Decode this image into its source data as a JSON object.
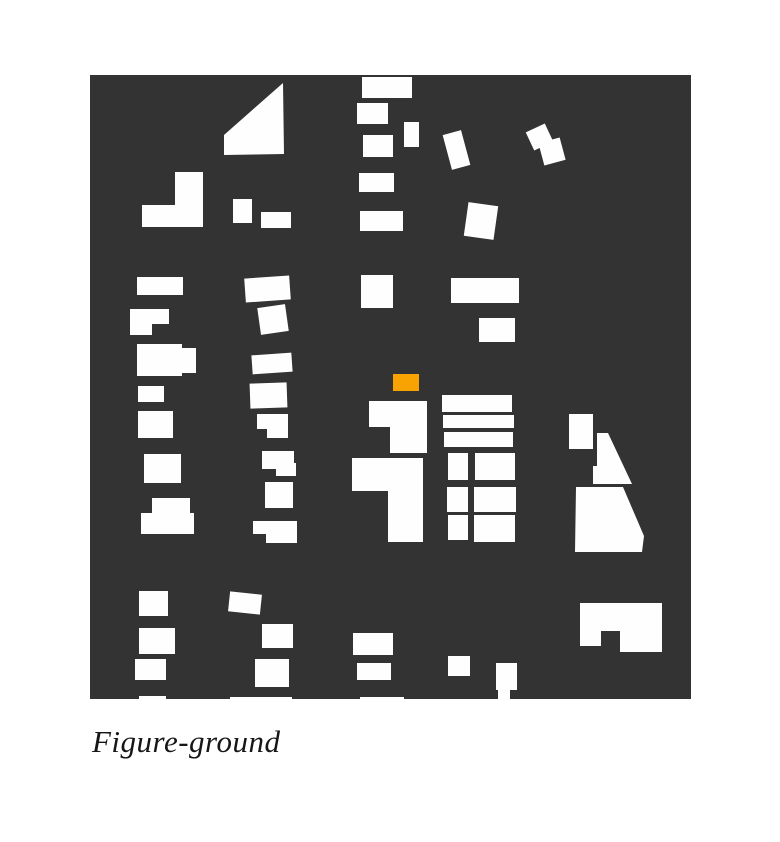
{
  "caption": {
    "text": "Figure-ground"
  },
  "colors": {
    "page_bg": "#ffffff",
    "ground": "#333333",
    "figure": "#fefefe",
    "highlight": "#F8A301"
  },
  "canvas": {
    "x": 90,
    "y": 75,
    "width": 601,
    "height": 624
  },
  "buildings": {
    "rects": [
      [
        272,
        2,
        50,
        21
      ],
      [
        267,
        28,
        31,
        21
      ],
      [
        314,
        47,
        15,
        25
      ],
      [
        273,
        60,
        30,
        22
      ],
      [
        269,
        98,
        35,
        19
      ],
      [
        270,
        136,
        43,
        20
      ],
      [
        271,
        200,
        32,
        33
      ],
      [
        85,
        97,
        28,
        55
      ],
      [
        52,
        130,
        61,
        22
      ],
      [
        143,
        124,
        19,
        24
      ],
      [
        171,
        137,
        30,
        16
      ],
      [
        357,
        57,
        19,
        36,
        -15
      ],
      [
        439,
        52,
        21,
        20,
        -25
      ],
      [
        451,
        65,
        22,
        23,
        -15
      ],
      [
        376,
        129,
        30,
        34,
        8
      ],
      [
        47,
        202,
        46,
        18
      ],
      [
        40,
        234,
        39,
        15
      ],
      [
        40,
        234,
        22,
        26
      ],
      [
        155,
        202,
        45,
        24,
        -4
      ],
      [
        169,
        231,
        28,
        27,
        -8
      ],
      [
        361,
        203,
        68,
        25
      ],
      [
        389,
        243,
        36,
        24
      ],
      [
        47,
        269,
        45,
        32
      ],
      [
        92,
        273,
        14,
        25
      ],
      [
        48,
        311,
        26,
        16
      ],
      [
        48,
        336,
        35,
        27
      ],
      [
        54,
        379,
        37,
        29
      ],
      [
        62,
        423,
        38,
        16
      ],
      [
        51,
        438,
        53,
        21
      ],
      [
        49,
        516,
        29,
        25
      ],
      [
        49,
        553,
        36,
        26
      ],
      [
        45,
        584,
        31,
        21
      ],
      [
        162,
        279,
        40,
        19,
        -4
      ],
      [
        160,
        308,
        37,
        25,
        -2
      ],
      [
        167,
        339,
        31,
        15
      ],
      [
        177,
        339,
        21,
        24
      ],
      [
        172,
        376,
        32,
        18
      ],
      [
        186,
        388,
        20,
        13
      ],
      [
        175,
        407,
        28,
        26
      ],
      [
        163,
        446,
        44,
        13
      ],
      [
        176,
        446,
        31,
        22
      ],
      [
        139,
        518,
        32,
        20,
        6
      ],
      [
        172,
        549,
        31,
        24
      ],
      [
        165,
        584,
        34,
        28
      ],
      [
        279,
        326,
        58,
        26
      ],
      [
        300,
        326,
        37,
        52
      ],
      [
        262,
        383,
        71,
        33
      ],
      [
        298,
        383,
        35,
        84
      ],
      [
        352,
        320,
        70,
        17
      ],
      [
        353,
        340,
        71,
        13
      ],
      [
        354,
        357,
        69,
        15
      ],
      [
        358,
        378,
        20,
        27
      ],
      [
        357,
        412,
        21,
        25
      ],
      [
        358,
        440,
        20,
        25
      ],
      [
        385,
        378,
        40,
        27
      ],
      [
        384,
        412,
        42,
        25
      ],
      [
        384,
        440,
        41,
        27
      ],
      [
        263,
        558,
        40,
        22
      ],
      [
        267,
        588,
        34,
        17
      ],
      [
        358,
        581,
        22,
        20
      ],
      [
        406,
        588,
        21,
        27
      ],
      [
        408,
        615,
        12,
        9
      ],
      [
        479,
        339,
        24,
        35
      ],
      [
        49,
        621,
        27,
        3
      ],
      [
        140,
        622,
        62,
        2
      ],
      [
        270,
        622,
        44,
        2
      ]
    ],
    "polygons": [
      [
        [
          193,
          8
        ],
        [
          194,
          79
        ],
        [
          134,
          80
        ],
        [
          134,
          60
        ]
      ],
      [
        [
          507,
          358
        ],
        [
          518,
          358
        ],
        [
          542,
          409
        ],
        [
          503,
          409
        ],
        [
          503,
          391
        ],
        [
          507,
          391
        ]
      ],
      [
        [
          486,
          412
        ],
        [
          533,
          412
        ],
        [
          554,
          461
        ],
        [
          552,
          477
        ],
        [
          485,
          477
        ]
      ],
      [
        [
          490,
          528
        ],
        [
          572,
          528
        ],
        [
          572,
          577
        ],
        [
          530,
          577
        ],
        [
          530,
          556
        ],
        [
          511,
          556
        ],
        [
          511,
          571
        ],
        [
          490,
          571
        ]
      ]
    ],
    "highlight_rect": [
      303,
      299,
      26,
      17
    ]
  }
}
